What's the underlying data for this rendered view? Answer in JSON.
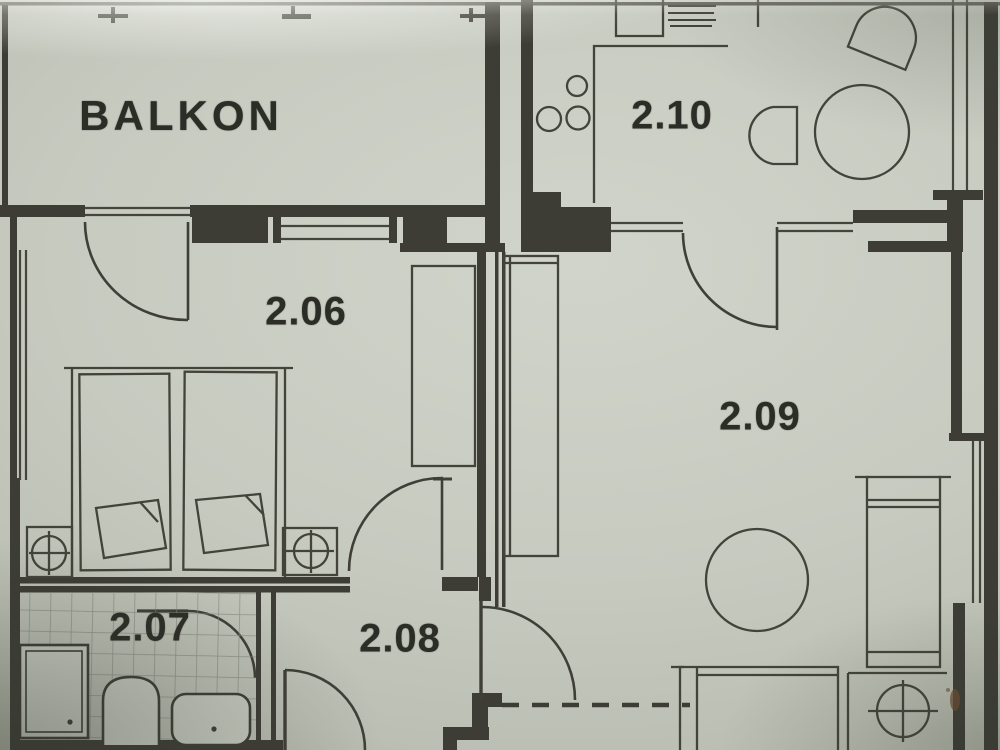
{
  "plan": {
    "labels": {
      "balkon": "BALKON",
      "room_206": "2.06",
      "room_207": "2.07",
      "room_208": "2.08",
      "room_209": "2.09",
      "room_210": "2.10"
    }
  },
  "colors": {
    "paper": "#c6cabf",
    "ink": "#3d3d35",
    "ink_thin": "#4a4a40",
    "tile_line": "#878c80",
    "stain": "#6d4f33"
  },
  "fixtures": [
    "double-bed",
    "pillow-left",
    "pillow-right",
    "nightstand-lamp-left",
    "nightstand-lamp-right",
    "wardrobe-206",
    "closet-209",
    "kitchen-counter",
    "hob-burners",
    "kitchen-sink",
    "dish-rack",
    "dining-round-table",
    "tub-chair-left",
    "tub-chair-top",
    "shower-tray",
    "toilet",
    "bidet",
    "living-round-table",
    "sofa",
    "bed-209",
    "nightstand-lamp-209",
    "door-swing-arcs",
    "window-glazing-lines",
    "survey-tick-marks"
  ]
}
